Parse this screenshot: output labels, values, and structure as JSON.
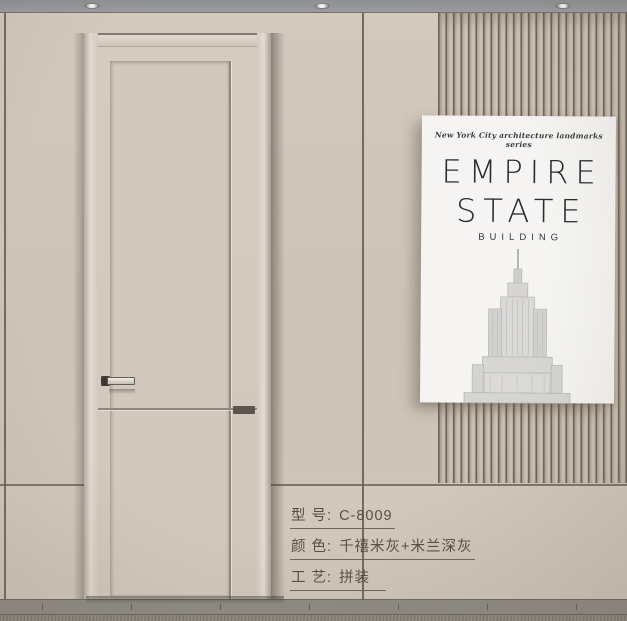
{
  "scene": {
    "description": "interior door product showcase",
    "ceiling_lights_count": 3
  },
  "poster": {
    "series_label": "New York City architecture landmarks series",
    "title_line1": "EMPIRE",
    "title_line2": "STATE",
    "subtitle": "BUILDING",
    "illustration": "empire-state-building-line-art"
  },
  "product_specs": {
    "rows": [
      {
        "label": "型 号:",
        "value": "C-8009"
      },
      {
        "label": "颜 色:",
        "value": "千禧米灰+米兰深灰"
      },
      {
        "label": "工 艺:",
        "value": "拼装"
      }
    ]
  },
  "colors": {
    "wall_beige": "#cec4b8",
    "door_cream": "#d3c9be",
    "accent_dark_gray": "#5a554e",
    "ceiling_gray": "#97989b",
    "floor_gray": "#8e8a84",
    "poster_white": "#f5f4f2",
    "spec_text": "#584f46"
  }
}
